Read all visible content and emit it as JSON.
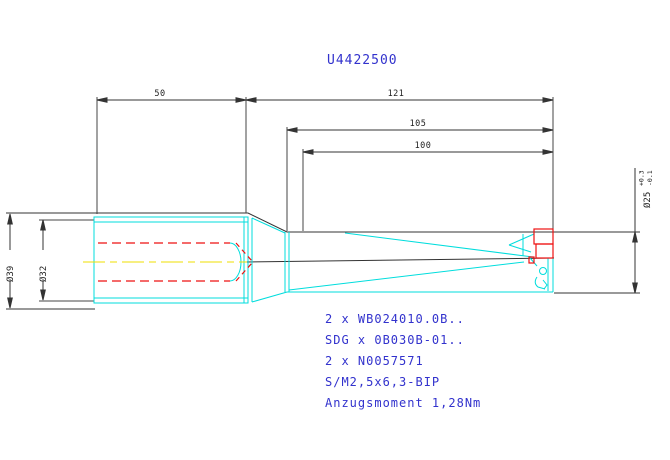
{
  "title": "U4422500",
  "dims": {
    "shank_length": "50",
    "overall_length": "121",
    "length_105": "105",
    "flute_length": "100",
    "shank_outer_dia": "Ø39",
    "shank_dia": "Ø32",
    "drill_dia": "Ø25",
    "drill_dia_tol_plus": "+0.3",
    "drill_dia_tol_minus": "-0.1"
  },
  "notes": {
    "inserts": "2 x WB024010.0B..",
    "grade": "SDG x 0B030B-01..",
    "spare_part": "2 x N0057571",
    "screw": "S/M2,5x6,3-BIP",
    "torque": "Anzugsmoment 1,28Nm"
  },
  "colors": {
    "dimension_lines": "#333333",
    "tool_geometry": "#00dddd",
    "hidden_and_inserts": "#ee1111",
    "centerline": "#efdf00",
    "annotation_text": "#3232cd"
  }
}
